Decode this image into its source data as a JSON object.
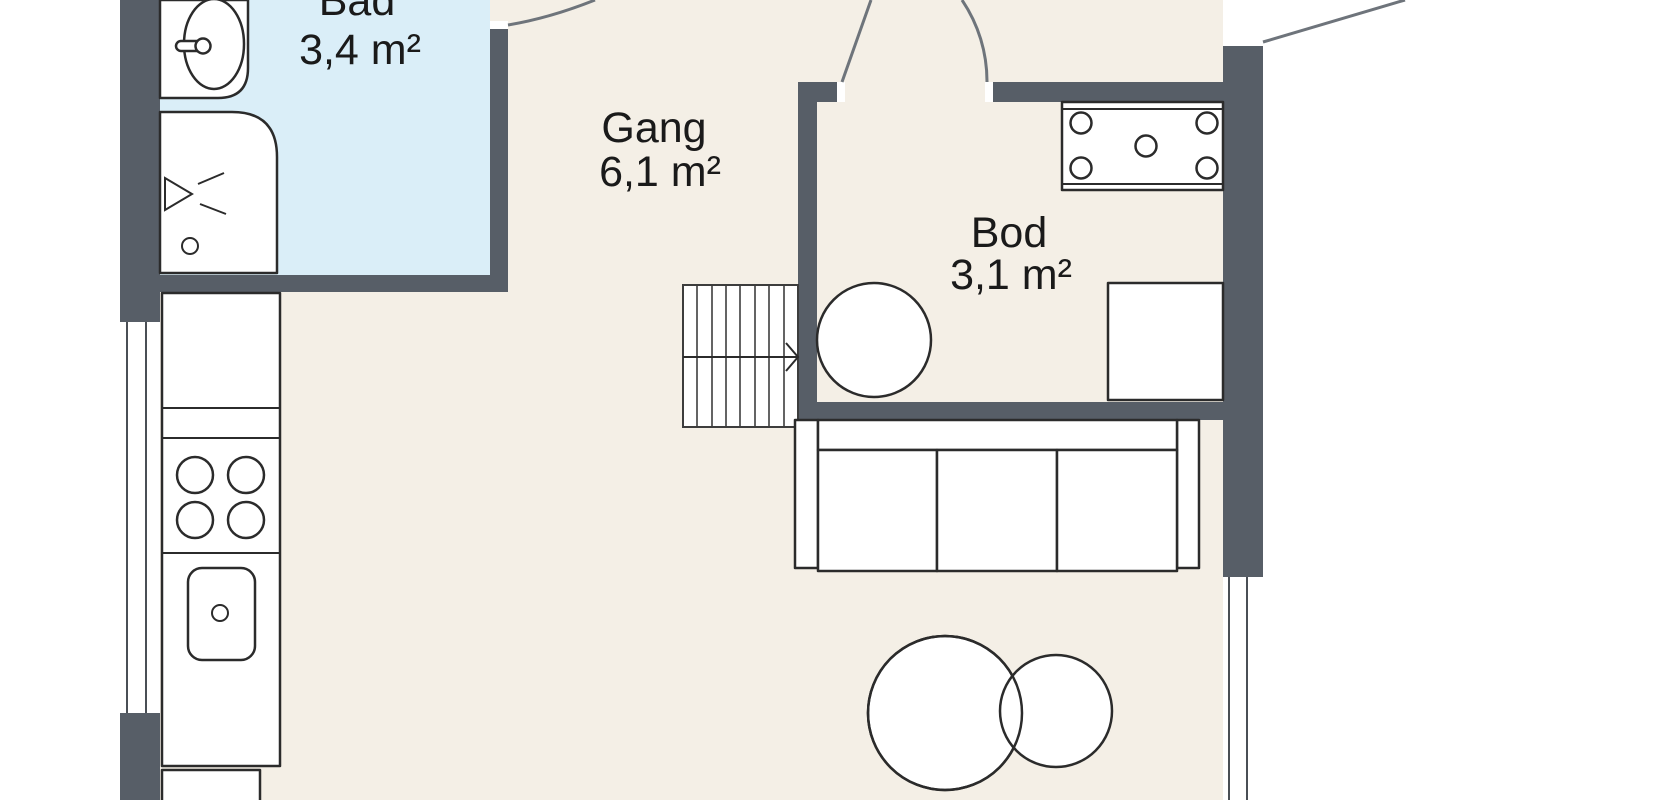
{
  "rooms": [
    {
      "id": "bad",
      "name": "Bad",
      "area": "3,4 m²"
    },
    {
      "id": "gang",
      "name": "Gang",
      "area": "6,1 m²"
    },
    {
      "id": "bod",
      "name": "Bod",
      "area": "3,1 m²"
    }
  ],
  "colors": {
    "wall": "#575E67",
    "floor": "#F4EFE6",
    "bathroom_floor": "#DAEEF8",
    "fixture_fill": "#FFFFFF",
    "fixture_outline": "#2B2B2B",
    "door_swing": "#6E747B",
    "label_text": "#1A1A1A"
  },
  "icons": {
    "shower_head": "shower-head-icon",
    "stairs_direction": "arrow-right"
  }
}
